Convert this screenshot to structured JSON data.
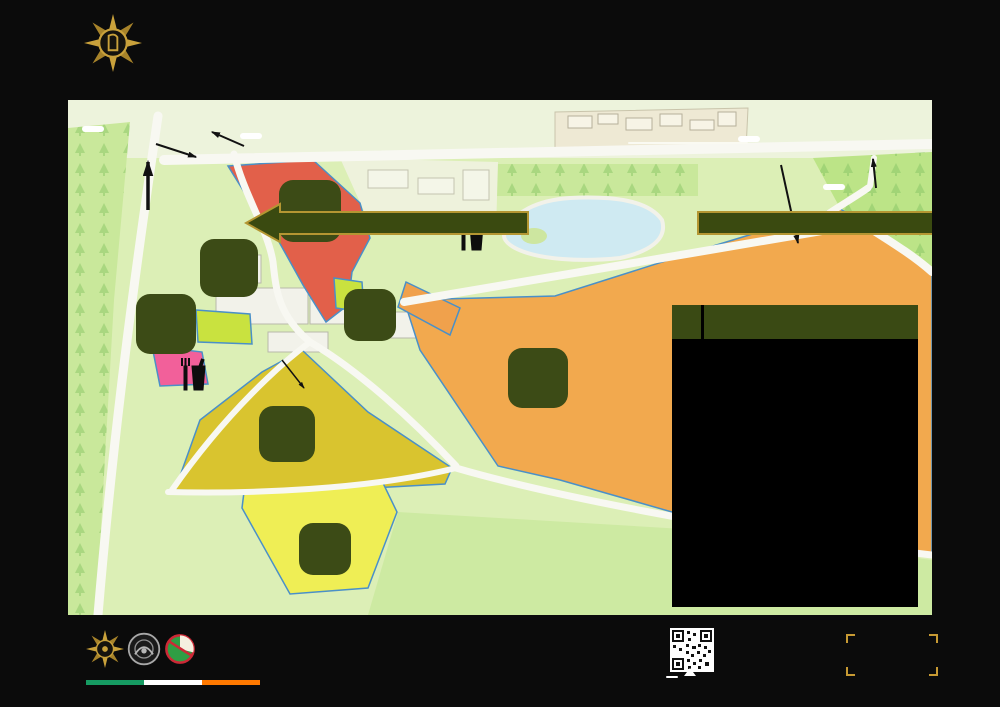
{
  "header": {
    "org_line1": "Óglaigh",
    "org_line2": "na hÉireann",
    "org_sub": "IRISH DEFENCE FORCES"
  },
  "banners": {
    "left": "FOR CASTLEKNOCK COLLEGE CAR PARK",
    "right": "FOR BUS STOPS, PHOENIX PARK, CITY"
  },
  "map": {
    "labels": {
      "bike_rack_left": "Bike Rack",
      "back_gate": "Back Gate",
      "whites_gate": "Whites Gate",
      "bike_rack_right": "Bike Rack",
      "main_gate": "Main Gate",
      "north": "N",
      "tower_rd": "Tower Rd.",
      "farmleigh": "Farmleigh",
      "farmleigh_house": "Farmleigh House"
    },
    "zones": {
      "a": "A",
      "b": "B",
      "c": "C",
      "d": "D",
      "l": "L",
      "m": "M",
      "p": "P"
    },
    "no_access": {
      "line1": "NO ACCESS FOR PUBLIC",
      "line2": "TO ZONE L [LANDING ZONE]"
    },
    "wc": "WC"
  },
  "map_key": {
    "title": "MAP KEY",
    "rows": [
      {
        "zone": "A",
        "theme": "dark",
        "items": [
          "Defence Forces Capability Displays"
        ]
      },
      {
        "zone": "B",
        "theme": "green",
        "items": [
          "DF No 1 Army Band",
          "Children's Play Area",
          "Survival Display",
          "Defence Forces Adventure Training Stand"
        ]
      },
      {
        "zone": "C",
        "theme": "dark",
        "items": [
          "Military Archives ‘Ask an Archivist’",
          "Civil War Records"
        ]
      },
      {
        "zone": "D",
        "theme": "green",
        "items": [
          "Information Tent",
          "Sliabh na mBan",
          "O.N.E Stand"
        ]
      },
      {
        "zone": "L",
        "theme": "dark",
        "items": [
          "Helicopter Landing Display",
          "Equestrian Display"
        ]
      },
      {
        "zone": "M",
        "theme": "green",
        "items": [
          "Farmers Market"
        ]
      },
      {
        "zone": "P",
        "theme": "dark",
        "items": [
          "Defence Forces Vehicle Display",
          "Recruitment Stand",
          "Dynamic Display Area"
        ]
      }
    ]
  },
  "footer": {
    "website": "www.military.ie",
    "scan_here": "Scan Here",
    "tagline_line1": "STRENGTHEN",
    "tagline_line2": "THE NATION"
  },
  "colors": {
    "zone_badge_green": "#3c4b16",
    "banner_green": "#3a4a10",
    "banner_gold": "#b49632",
    "zone_b_red": "#e2604a",
    "zone_a_mustard": "#d9c42f",
    "zone_l_orange": "#f2a94e",
    "zone_p_yellow": "#efee55",
    "zone_m_pink": "#f2609a",
    "map_green": "#dcefb6",
    "lake_blue": "#cfeaf2",
    "tagline_gold": "#c79a33",
    "tricolor": [
      "#169b62",
      "#ffffff",
      "#ff7900"
    ]
  }
}
